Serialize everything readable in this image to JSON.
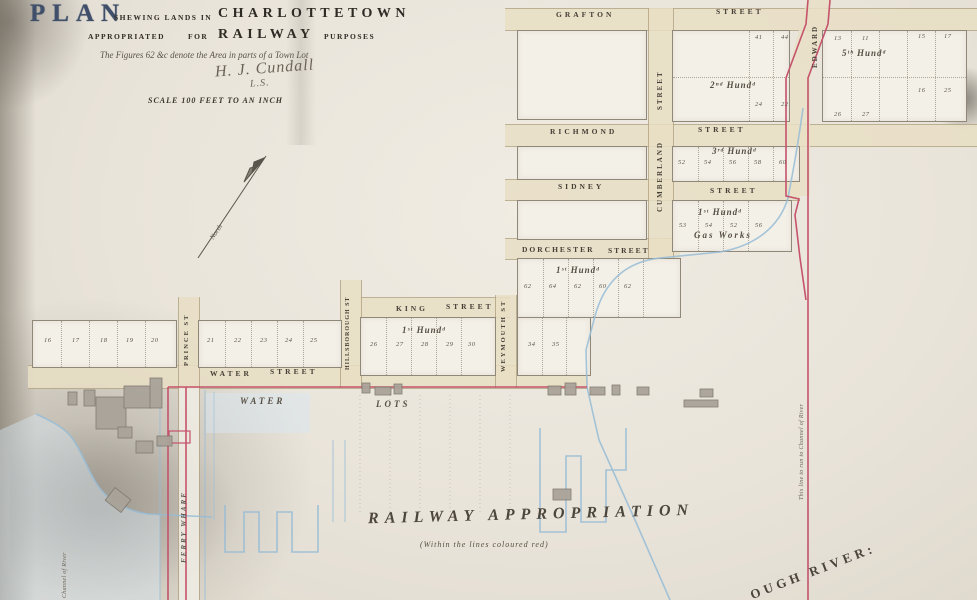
{
  "title": {
    "plan": "PLAN",
    "shewing": "SHEWING LANDS IN",
    "city": "CHARLOTTETOWN",
    "appropriated": "APPROPRIATED",
    "for_word": "FOR",
    "railway": "RAILWAY",
    "purposes": "PURPOSES",
    "figures_note": "The Figures 62 &c denote the Area in parts of a Town Lot",
    "signature": "H. J. Cundall",
    "signature_suffix": "L.S.",
    "scale": "SCALE 100 FEET TO AN INCH"
  },
  "compass": {
    "label": "North"
  },
  "streets": {
    "grafton": {
      "name": "GRAFTON",
      "suffix": "STREET"
    },
    "richmond": {
      "name": "RICHMOND",
      "suffix": "STREET"
    },
    "sidney": {
      "name": "SIDNEY",
      "suffix": "STREET"
    },
    "dorchester": {
      "name": "DORCHESTER",
      "suffix": "STREET"
    },
    "king": {
      "name": "KING",
      "suffix": "STREET"
    },
    "water": {
      "name": "WATER",
      "suffix": "STREET"
    },
    "prince": {
      "name": "PRINCE ST",
      "suffix": ""
    },
    "hillsborough": {
      "name": "HILLSBOROUGH ST",
      "suffix": ""
    },
    "weymouth": {
      "name": "WEYMOUTH ST",
      "suffix": ""
    },
    "cumberland": {
      "name": "CUMBERLAND",
      "suffix": "STREET"
    },
    "edward": {
      "name": "EDWARD",
      "suffix": ""
    }
  },
  "blocks": {
    "hund2": {
      "label": "2ⁿᵈ Hundᵈ",
      "numbers": [
        "41",
        "44",
        "24",
        "22"
      ]
    },
    "hund5": {
      "label": "5ᵗʰ Hundᵈ",
      "numbers": [
        "13",
        "11",
        "15",
        "17",
        "26",
        "27",
        "16",
        "25"
      ]
    },
    "hund3": {
      "label": "3ʳᵈ Hundᵈ",
      "numbers": [
        "52",
        "54",
        "56",
        "58",
        "60"
      ]
    },
    "gasworks": {
      "label": "1ˢᵗ Hundᵈ",
      "caption": "Gas Works",
      "numbers": [
        "53",
        "54",
        "52",
        "56"
      ]
    },
    "dorchester_block": {
      "label": "1ˢᵗ Hundᵈ",
      "numbers": [
        "62",
        "64",
        "62",
        "60",
        "62"
      ]
    },
    "king_block": {
      "label": "1ˢᵗ Hundᵈ",
      "numbers": [
        "26",
        "27",
        "28",
        "29",
        "30"
      ]
    },
    "weymouth_block": {
      "numbers": [
        "34",
        "35"
      ]
    },
    "water_row_west": {
      "numbers": [
        "16",
        "17",
        "18",
        "19",
        "20"
      ]
    },
    "water_row_east": {
      "numbers": [
        "21",
        "22",
        "23",
        "24",
        "25"
      ]
    }
  },
  "annotations": {
    "water_word": "WATER",
    "lots_word": "LOTS",
    "railway_appropriation": "RAILWAY APPROPRIATION",
    "railway_sub": "(Within the lines coloured red)",
    "ferry_wharf": "FERRY WHARF",
    "river": "OUGH RIVER:",
    "red_line_note": "This line to run to Channel of River",
    "wharf_note": "Channel of River"
  },
  "colors": {
    "red_boundary": "#c4536b",
    "water_blue": "#96bcd6",
    "street_fill": "#e9dfc5",
    "title_blue": "#41506a",
    "ink": "#46413a"
  }
}
